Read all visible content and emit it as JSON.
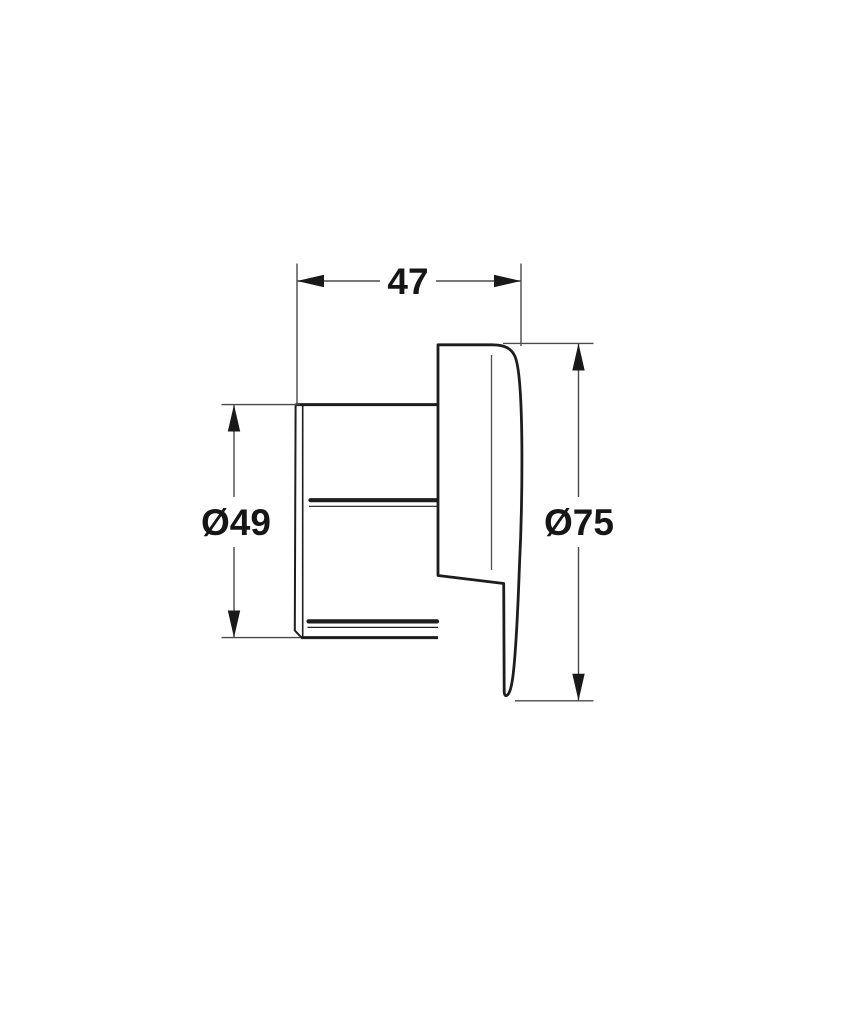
{
  "page": {
    "background": "#ffffff"
  },
  "drawing": {
    "kind": "technical-dimension-drawing",
    "colors": {
      "outline": "#1d1d1d",
      "dimension_lines": "#4a4a4a",
      "label_text": "#161616"
    },
    "dimensions": [
      {
        "id": "width",
        "label": "47",
        "orientation": "horizontal"
      },
      {
        "id": "body-diameter",
        "label": "Ø49",
        "orientation": "vertical"
      },
      {
        "id": "faceplate-diameter",
        "label": "Ø75",
        "orientation": "vertical"
      }
    ]
  }
}
